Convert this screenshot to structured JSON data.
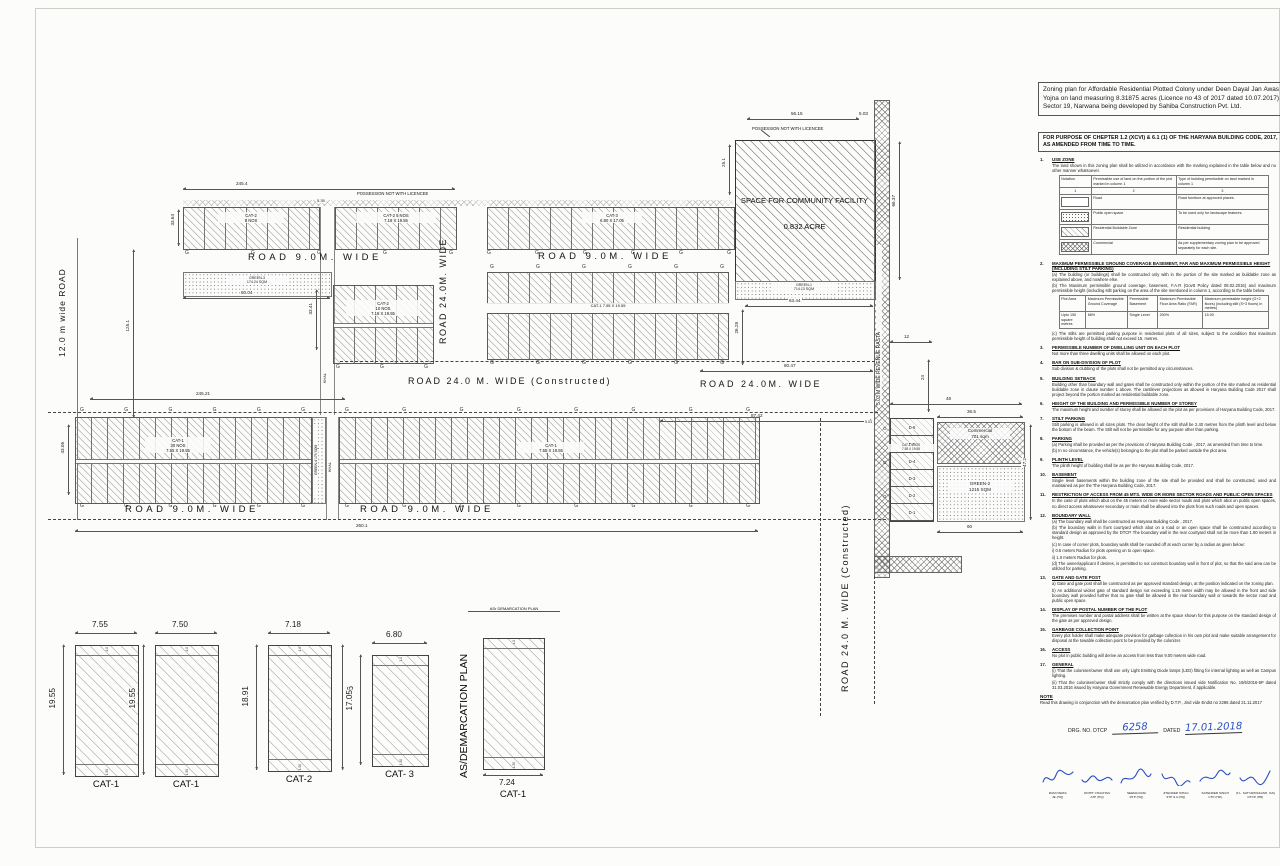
{
  "plan": {
    "roads": {
      "r12": "12.0 m wide ROAD",
      "r9": "ROAD  9.0M.  WIDE",
      "r24": "ROAD  24.0M.  WIDE",
      "r24c": "ROAD  24.0 M.  WIDE (Constructed)",
      "rasta": "5.03 M WIDE REVENUE RASTA"
    },
    "khal": "KHAL",
    "g": "G",
    "possession": "POSSESSION NOT WITH LICENCEE",
    "community": {
      "l1": "SPACE FOR COMMUNITY FACILITY",
      "l2": "0.832 ACRE"
    },
    "greens": {
      "g1a": "GREEN-1",
      "g1b": "714.13 SQM",
      "g2a": "GREEN-2",
      "g2b": "1215 SQM",
      "g3a": "GREEN-3",
      "g3b": "174.24 SQM",
      "g4": "GREEN-4 175 SQM"
    },
    "commercial": {
      "l1": "Commercial",
      "l2": "701 sqm"
    },
    "blocks": {
      "a1a": "CAT-2",
      "a1b": "8 NOS",
      "a2a": "CAT-2  5 NOS",
      "a2b": "7.18 X 19.55",
      "a3a": "CAT-3",
      "a3b": "6.80 X 17.05",
      "ba": "CAT-2",
      "bb": "10 NOS",
      "bc": "7.18 X 19.55",
      "ra": "CAT-1   7.55 X 19.55",
      "l1a": "CAT-1",
      "l1b": "30 NOS",
      "l1c": "7.55 X 19.55",
      "l2a": "CAT-1",
      "l2b": "7.55 X 19.55",
      "da": "CAT-1  6NOS",
      "db": "7.55 X 19.55"
    },
    "d_plots": [
      "D-6",
      "D-5",
      "D-4",
      "D-3",
      "D-2",
      "D-1"
    ],
    "dims": {
      "top245": "245.4",
      "k535": "5.35",
      "v3364": "33.64",
      "v3341": "33.41",
      "v1251": "125.1",
      "h6004": "60.04",
      "c5615": "56.15",
      "c503": "5.03",
      "c251": "25.1",
      "c6637": "66.37",
      "g6344": "63.44",
      "g2628": "26.28",
      "r8047": "80.47",
      "r8742": "87.42",
      "r24521": "245.21",
      "b2601": "260.1",
      "v4306": "43.06",
      "d48": "48",
      "d365": "36.5",
      "d472": "47.2",
      "d60": "60",
      "d12": "12",
      "d24": "24",
      "d503": "5.03"
    }
  },
  "demarcation": {
    "side_label": "AS/DEMARCATION PLAN",
    "top_label": "ASr DEMARCATION PLAN",
    "plots": [
      {
        "cat": "CAT-1",
        "front_width": "7.55",
        "depth": "19.55",
        "back_strip": "1.0",
        "front_strip": "1.50"
      },
      {
        "cat": "CAT-1",
        "front_width": "7.50",
        "depth": "19.55",
        "back_strip": "1.0",
        "front_strip": "1.50"
      },
      {
        "cat": "CAT-2",
        "front_width": "7.18",
        "depth": "18.91",
        "depth_right": "18.96",
        "back_strip": "1.0",
        "front_strip": "1.50"
      },
      {
        "cat": "CAT- 3",
        "front_width": "6.80",
        "depth": "17.05",
        "back_strip": "1.0",
        "front_strip": "1.50"
      },
      {
        "cat": "CAT-1",
        "front_width": "7.24",
        "back_strip": "1.0",
        "front_strip": "1.50"
      }
    ]
  },
  "panel": {
    "title": "Zoning plan for Affordable Residential Plotted Colony under Deen Dayal Jan Awas Yojna on land measuring 8.31875 acres (Licence no 43 of 2017 dated 10.07.2017)  Sector 19, Narwana being developed by Sahiba Construction  Pvt. Ltd.",
    "purpose": "FOR PURPOSE OF CHEPTER 1.2 (XCVI) & 6.1 (1) OF THE HARYANA BUILDING CODE, 2017, AS AMENDED FROM TIME TO TIME.",
    "use_zone_table": {
      "headers": [
        "Notation",
        "Permissible use of land on the portion of the plot marked in column 1",
        "Type of building permissible on land marked in column 1"
      ],
      "col_nos": [
        "1",
        "2",
        "3"
      ],
      "rows": [
        {
          "swatch": "road",
          "use": "Road",
          "type": "Road furniture at approved places."
        },
        {
          "swatch": "open",
          "use": "Public open space",
          "type": "To be used only for landscape features."
        },
        {
          "swatch": "residential",
          "use": "Residential Buildable Zone",
          "type": "Residential building"
        },
        {
          "swatch": "commercial",
          "use": "Commercial",
          "type": "As per supplementary zoning plan to be approved separately for each site."
        }
      ]
    },
    "coverage_table": {
      "headers": [
        "Plot Area",
        "Maximum Permissible Ground Coverage",
        "Permissible Basement",
        "Maximum Permissible Floor Area Ratio (FAR)",
        "Maximum permissible height (G+2 floors) (including stilt (S+3 floors) in metres)"
      ],
      "row": [
        "Upto 150 square metres",
        "66%",
        "Single Level",
        "200%",
        "15.00"
      ]
    },
    "notes": [
      {
        "no": "1.",
        "h": "USE ZONE",
        "p": [
          "The land shown in this zoning plan shall be utilized in accordance with the marking explained in the table below and no other manner whatsoever."
        ],
        "table": "use_zone"
      },
      {
        "no": "2.",
        "h": "MAXIMUM PERMISSIBLE GROUND COVERAGE BASEMENT, FAR AND MAXIMUM PERMISSIBLE HEIGHT (INCLUDING STILT PARKING)",
        "p": [
          "(a)  The building (or buildings) shall be constructed only with in the portion of the site marked as buildable zone as explained above, and nowhere else.",
          "(b)  The Maximum permissible ground coverage, basement, F.A.R (Govtt Policy dated 08.02.2016) and maximum permissible height (including stilt parking on the area of the site mentioned in column 1, according to the table below"
        ],
        "table": "coverage",
        "p2": [
          "(c)  The stilts are permitted parking purpose in residential plots of all sizes, subject to the condition that maximum permissible height of building shall not exceed 15. metres."
        ]
      },
      {
        "no": "3.",
        "h": "PERMISSIBLE NUMBER OF DWELLING UNIT ON EACH PLOT",
        "p": [
          "Not more than three dwelling units shall be allowed on each plot."
        ]
      },
      {
        "no": "4.",
        "h": "BAR ON SUB-DIVISION OF PLOT",
        "p": [
          "Sub division & clubbing of the plots shall not be permitted any circumstances."
        ]
      },
      {
        "no": "5.",
        "h": "BUILDING SETBACK",
        "p": [
          "Building other than boundary wall and gates shall be constructed only within the portion of the site marked as residential buildable zone in clause number 1 above. The cantilever projections as allowed in Haryana Building Code 2017 shall project beyond the portion marked as residential buildable zone."
        ]
      },
      {
        "no": "6.",
        "h": "HEIGHT OF THE BUILDING AND PERMISSIBLE NUMBER OF STOREY",
        "p": [
          "The maximum height and number of storey shall be allowed on the plot as per provisions of Haryana Building Code, 2017."
        ]
      },
      {
        "no": "7.",
        "h": "STILT PARKING",
        "p": [
          "Stilt parking is allowed in all sizes plots. The clear height of the stilt shall be 2.40 metres from the plinth level and below the bottom of the beam. The Stilt will not be permissible for any purpose other than parking."
        ]
      },
      {
        "no": "8.",
        "h": "PARKING",
        "p": [
          "(a)  Parking shall be provided as per the provisions of Haryana Building Code , 2017, as amended from time to time.",
          "(b)  In no circumstance, the vehicle(s) belonging to the plot shall be parked outside the plot area."
        ]
      },
      {
        "no": "9.",
        "h": "PLINTH LEVEL",
        "p": [
          "The plinth height of building shall be as per the Haryana Building Code, 2017."
        ]
      },
      {
        "no": "10.",
        "h": "BASEMENT",
        "p": [
          "Single level basements within the building zone of the site shall be provided and shall be constructed, used and maintained as per the The Haryana Building Code, 2017."
        ]
      },
      {
        "no": "11.",
        "h": "RESTRICTION OF ACCESS FROM 45 MTS. WIDE OR MORE SECTOR ROADS AND PUBLIC OPEN SPACES",
        "p": [
          "In the case of plots which abut on the 45 meters or more wide sector roads and plots which abut on public open spaces, no direct access whatsoever secondary or main shall be allowed into the plots from such roads and open spaces."
        ]
      },
      {
        "no": "12.",
        "h": "BOUNDARY WALL",
        "p": [
          "(a)  The boundary wall shall be constructed as Haryana Building Code , 2017.",
          "(b)  The boundary walls in front courtyard which abut on a road or an open space shall be constructed according to standard design as approved by the DTCP. The boundary wall in the rear courtyard shall not be more than 1.80 meters in height.",
          "(c)  In case of corner plots, boundary walls shall be rounded off at each corner by a radius as given below:",
          "i)  0.5 meters Radius for plots opening on to open space.",
          "ii)  1.0 meters Radius for plots.",
          "(d)  The owner/applicant if desires, is permitted to not construct boundary wall in front of plot, so that the said area can be utilized for parking."
        ]
      },
      {
        "no": "13.",
        "h": "GATE AND GATE POST",
        "p": [
          "a)  Gate and gate post shall be constructed as per approved standard design, at the position indicated on the zoning plan.",
          "b)  An additional wicket gate of standard design not exceeding 1.15 meter width may be allowed in the front and side boundary wall provided further that no gate shall be allowed in the rear boundary wall or towards the sector road and public open space."
        ]
      },
      {
        "no": "14.",
        "h": "DISPLAY OF POSTAL NUMBER OF THE PLOT",
        "p": [
          "The premises number and postal address shall be written at the space shown for this purpose on the standard design of the gate as per approved design."
        ]
      },
      {
        "no": "15.",
        "h": "GARBAGE COLLECTION POINT",
        "p": [
          "Every plot holder shall make adequate provision for garbage collection in his own plot and make suitable arrangement for disposal at the towable collection point to be provided by the colonizer."
        ]
      },
      {
        "no": "16.",
        "h": "ACCESS",
        "p": [
          "No plot in public building will derive an access from less than 9.00 meters wide road."
        ]
      },
      {
        "no": "17.",
        "h": "GENERAL",
        "p": [
          "(i)  That the coloniser/owner shall use only Light Emitting Diode lamps (LED) fitting for internal lighting as well as Campus lighting.",
          "(ii)  That the coloniser/owner shall strictly comply with the directions issued vide Notification No. 19/6/2016-5P dated 31.03.2016 issued by Haryana Government Renewable Energy Department, if applicable.",
          "(iii)  That coloniser/owner shall ensure the installation of Solar Power Plant as per provisions of Haryana Solar Power Policy 2016 issued by Haryana Government Renewable Energy Department vide Notification No. 19/4/2016-5 Power dated 14.03.2016, if applicable.",
          "(iv)  That the coloniser/owner shall ensure the installation of Solar Photovoltaic Power Plant as per the provisions of order No. 22/52/2005-5Power dated 21.03.2016 issued by Haryana Government Renewable Energy Department, if applicable."
        ]
      }
    ],
    "note_heading": "NOTE",
    "note_text": "Read this drawing in conjunction with the demarcation plan verified by D.T.P., Jind vide Endst no 2286 dated 21.11.2017",
    "drg": {
      "label": "DRG. NO. DTCP",
      "number": "6258",
      "dated_label": "DATED",
      "date": "17.01.2018"
    },
    "signatures": [
      {
        "name": "RAM NIWAS",
        "post": "JE (HQ)"
      },
      {
        "name": "ROHIT CHAUHAN",
        "post": "ATP (HQ)"
      },
      {
        "name": "SEEMA RANI",
        "post": "DTP (HQ)"
      },
      {
        "name": "JITENDER SIHAG",
        "post": "STP & A (HQ)"
      },
      {
        "name": "SATENDER SINGH",
        "post": "CTP (HR)"
      },
      {
        "name": "(T.L. SATYAPRAKASH, IAS)",
        "post": "DTCP (HR)"
      }
    ]
  }
}
